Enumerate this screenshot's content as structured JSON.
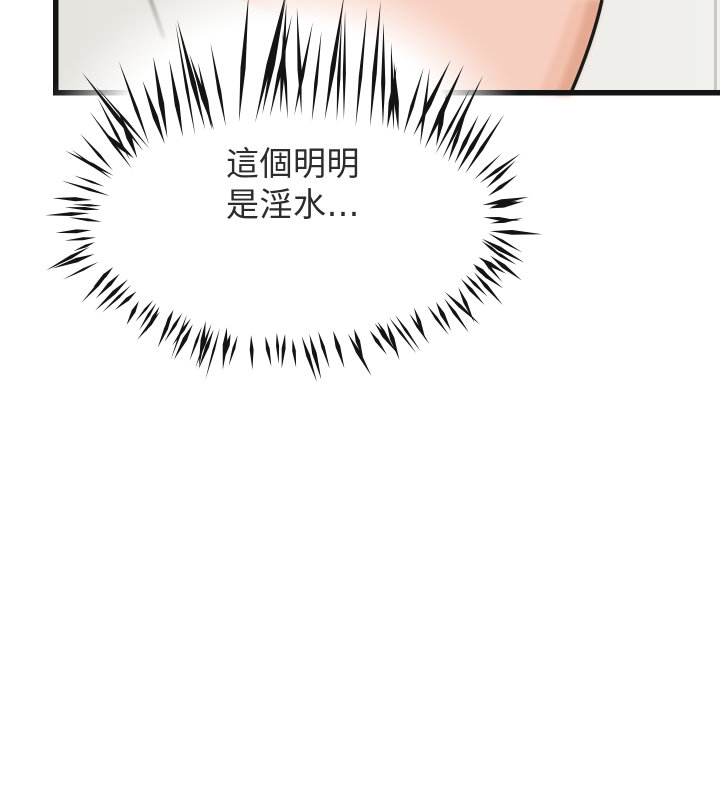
{
  "page": {
    "background": "#ffffff"
  },
  "panel": {
    "tile_color_left": "#e6e4df",
    "tile_color_right": "#f1f0ec",
    "grout_color": "#a2a09a",
    "border_color": "#141414",
    "right_edge_color": "#c9c7c3",
    "skin_color": "#f7cfc0",
    "skin_mid_shadow_color": "#efb8a2",
    "skin_shadow_color": "#e2a58c",
    "skin_outline_color": "#1b1b1b"
  },
  "speech_bubble": {
    "fill": "#ffffff",
    "spike_color": "#141414",
    "text_color": "#2c2c2c",
    "line1": "這個明明",
    "line2": "是淫水…"
  }
}
